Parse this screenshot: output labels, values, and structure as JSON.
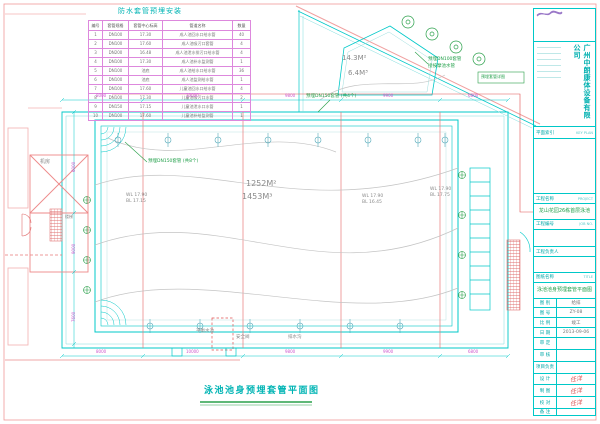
{
  "sheet": {
    "title_bottom": "泳池池身预埋套管平面图"
  },
  "sleeve_table": {
    "title": "防水套管预埋安装",
    "headers": [
      "编号",
      "套管规格",
      "套管中心标高",
      "管道名称",
      "数量"
    ],
    "rows": [
      [
        "1",
        "DN100",
        "17.30",
        "成人池回水口给水管",
        "40"
      ],
      [
        "2",
        "DN100",
        "17.60",
        "成人池吸污口套管",
        "4"
      ],
      [
        "3",
        "DN200",
        "16.48",
        "成人池泄水排污口给水管",
        "4"
      ],
      [
        "4",
        "DN100",
        "17.30",
        "成人池补水监测管",
        "1"
      ],
      [
        "5",
        "DN100",
        "池底",
        "成人池给水口给水管",
        "36"
      ],
      [
        "6",
        "DN100",
        "池底",
        "成人池监测给水管",
        "1"
      ],
      [
        "7",
        "DN100",
        "17.60",
        "儿童池回水口给水管",
        "4"
      ],
      [
        "8",
        "DN100",
        "17.30",
        "儿童池吸污口水管",
        "2"
      ],
      [
        "9",
        "DN150",
        "17.15",
        "儿童池泄水口水管",
        "1"
      ],
      [
        "10",
        "DN100",
        "17.60",
        "儿童池补给监测管",
        "1"
      ]
    ]
  },
  "plan": {
    "pool_area": "1252M²",
    "pool_volume": "1453M³",
    "spa_area": "14.3M²",
    "spa_volume": "6.4M³",
    "levels": [
      {
        "wl": "WL 17.90",
        "bl": "BL 17.15"
      },
      {
        "wl": "WL 17.90",
        "bl": "BL 16.45"
      },
      {
        "wl": "WL 17.90",
        "bl": "BL 17.75"
      }
    ],
    "green_labels": {
      "left": "预埋DN150套管 (共8个)",
      "mid": "预埋DN150套管 (共4个)",
      "spa1": "预埋DN100套管",
      "spa2": "接按摩池水管",
      "boxed": "预埋套管详图"
    },
    "room_labels": {
      "machine": "机房",
      "stair": "楼梯"
    },
    "bottom_labels": {
      "tank": "平衡水池",
      "valve": "安全阀",
      "gutter": "排水沟"
    },
    "dims_top": [
      "8000",
      "10000",
      "9800",
      "9900",
      "6800"
    ],
    "dims_left": [
      "6000",
      "9000",
      "7600"
    ],
    "dims_bottom": [
      "8000",
      "10000",
      "9800",
      "9900",
      "6800"
    ]
  },
  "title_block": {
    "company": "广州中朗康体设备有限公司",
    "key_plan_label": "平面索引",
    "key_plan_en": "KEY PLAN",
    "project_label": "工程名称",
    "project_en": "PROJECT",
    "project_name": "龙山花园26栋首层泳池",
    "job_label": "工程编号",
    "job_en": "JOB NO.",
    "manager_label": "工程负责人",
    "title_label": "图纸名称",
    "title_en": "TITLE",
    "drawing_title": "泳池池身预埋套管平面图",
    "rows": [
      {
        "label": "图 别",
        "value": "给排"
      },
      {
        "label": "图 号",
        "value": "ZY-08"
      },
      {
        "label": "比 例",
        "value": "竣工"
      },
      {
        "label": "日 期",
        "value": "2013-09-06"
      },
      {
        "label": "审 定",
        "value": ""
      },
      {
        "label": "审 核",
        "value": ""
      },
      {
        "label": "项目负责",
        "value": ""
      },
      {
        "label": "设 计",
        "value": "任洋"
      },
      {
        "label": "制 图",
        "value": "任洋"
      },
      {
        "label": "校 对",
        "value": "任洋"
      },
      {
        "label": "备 注",
        "value": ""
      }
    ]
  }
}
